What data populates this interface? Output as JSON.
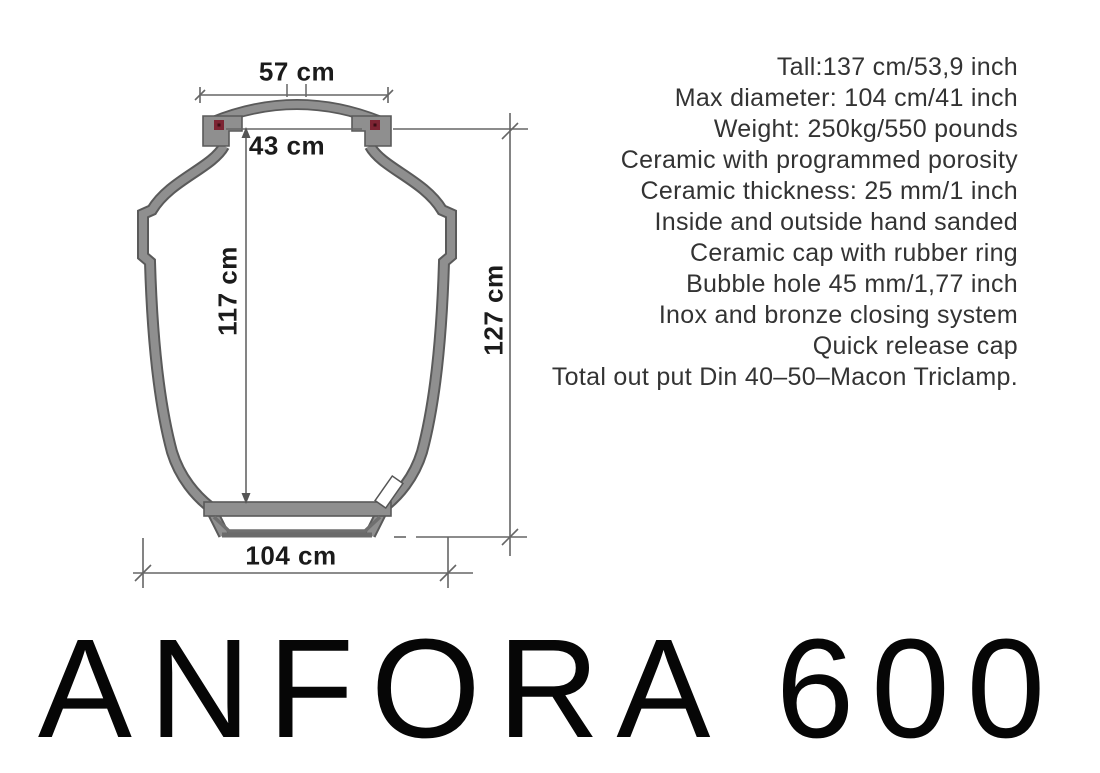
{
  "title": "ANFORA 600",
  "specs": {
    "lines": [
      "Tall:137 cm/53,9 inch",
      "Max diameter: 104 cm/41 inch",
      "Weight: 250kg/550 pounds",
      "Ceramic with programmed porosity",
      "Ceramic thickness: 25 mm/1 inch",
      "Inside and outside hand sanded",
      "Ceramic cap with rubber ring",
      "Bubble hole 45 mm/1,77 inch",
      "Inox and bronze closing system",
      "Quick release cap",
      "Total out put Din 40–50–Macon Triclamp."
    ]
  },
  "diagram": {
    "labels": {
      "cap_width": "57 cm",
      "mouth_width": "43 cm",
      "inner_height": "117 cm",
      "outer_height": "127 cm",
      "max_diameter": "104 cm"
    },
    "colors": {
      "body_fill": "#8f8f8f",
      "body_outline": "#5a5a5a",
      "marker_red": "#7d2433",
      "marker_dot": "#3c0d14",
      "dimension_line": "#666666",
      "valve_fill": "#ffffff",
      "text_dark": "#1b1b1b"
    }
  }
}
